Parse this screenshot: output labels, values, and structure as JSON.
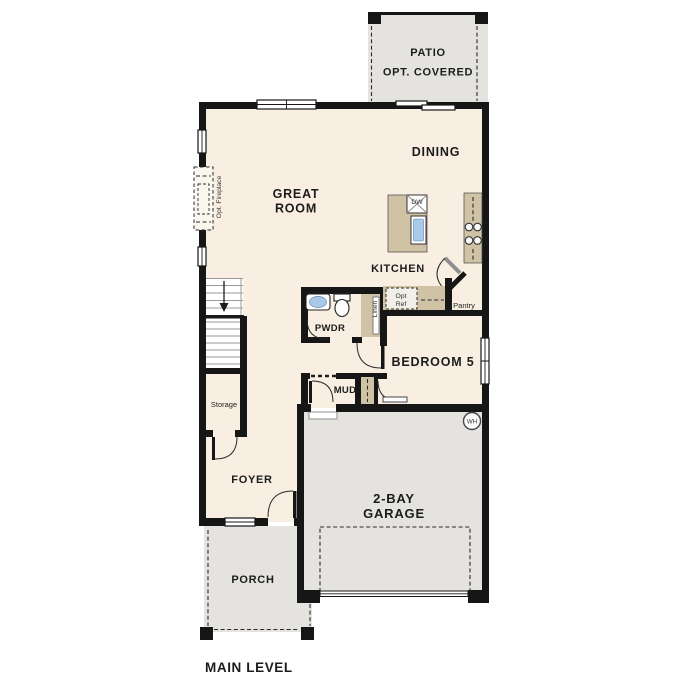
{
  "title": {
    "label": "MAIN LEVEL"
  },
  "rooms": {
    "patio": {
      "line1": "PATIO",
      "line2": "OPT. COVERED"
    },
    "great_room": {
      "line1": "GREAT",
      "line2": "ROOM"
    },
    "dining": {
      "label": "DINING"
    },
    "kitchen": {
      "label": "KITCHEN"
    },
    "pantry": {
      "label": "Pantry"
    },
    "powder": {
      "label": "PWDR"
    },
    "linen": {
      "label": "Linen"
    },
    "bedroom5": {
      "label": "BEDROOM 5"
    },
    "mud": {
      "label": "MUD"
    },
    "storage": {
      "label": "Storage"
    },
    "foyer": {
      "label": "FOYER"
    },
    "garage": {
      "line1": "2-BAY",
      "line2": "GARAGE"
    },
    "porch": {
      "label": "PORCH"
    }
  },
  "fixtures": {
    "dishwasher_label": "DW",
    "water_heater_label": "WH",
    "opt_ref_line1": "Opt",
    "opt_ref_line2": "Ref",
    "opt_fireplace_label": "Opt. Fireplace"
  },
  "colors": {
    "floor": "#f8eee2",
    "outdoor_concrete": "#e4e3e0",
    "cabinet_tan": "#d0c3a5",
    "wall": "#161616",
    "sink_blue": "#a9c9e9",
    "text": "#1c1c1c"
  }
}
